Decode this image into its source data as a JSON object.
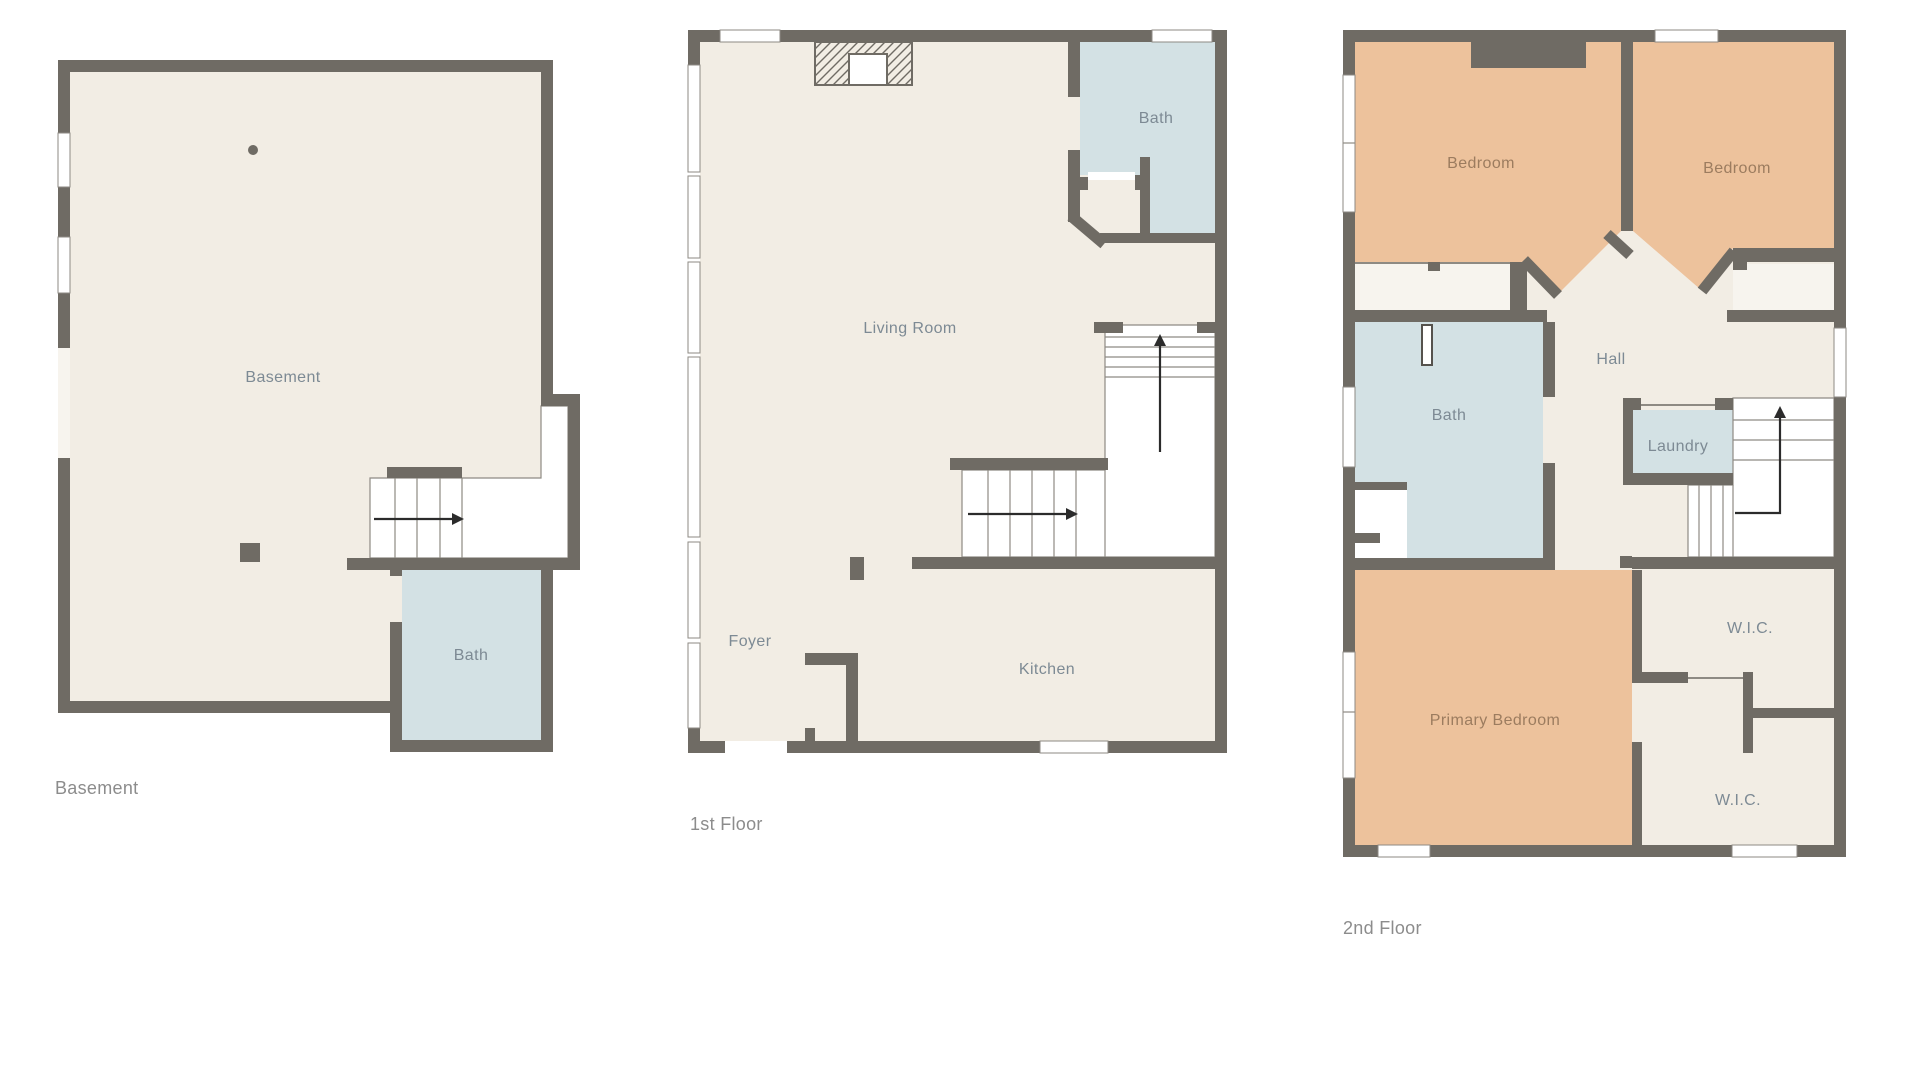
{
  "colors": {
    "wall": "#6f6b64",
    "floor": "#f2ede4",
    "bath_floor": "#d3e1e4",
    "bedroom_floor": "#edc29c",
    "closet_floor": "#f7f4ee",
    "stair_fill": "#ffffff",
    "room_label": "#7d8a94",
    "bedroom_label": "#9c7c5f",
    "floor_label": "#8c8c8c"
  },
  "floors": [
    {
      "id": "basement",
      "label": "Basement",
      "rooms": {
        "basement": "Basement",
        "bath": "Bath"
      }
    },
    {
      "id": "first-floor",
      "label": "1st Floor",
      "rooms": {
        "living_room": "Living Room",
        "bath": "Bath",
        "foyer": "Foyer",
        "kitchen": "Kitchen"
      }
    },
    {
      "id": "second-floor",
      "label": "2nd Floor",
      "rooms": {
        "bedroom_left": "Bedroom",
        "bedroom_right": "Bedroom",
        "bath": "Bath",
        "hall": "Hall",
        "laundry": "Laundry",
        "primary_bedroom": "Primary Bedroom",
        "wic_upper": "W.I.C.",
        "wic_lower": "W.I.C."
      }
    }
  ]
}
